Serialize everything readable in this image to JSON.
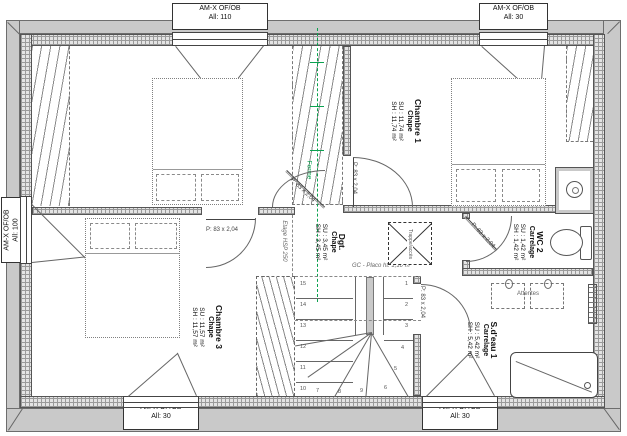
{
  "plan": {
    "windows": [
      {
        "id": "top-left",
        "line1": "AM-X OF/OB",
        "line2": "All: 110"
      },
      {
        "id": "top-right",
        "line1": "AM-X OF/OB",
        "line2": "All: 30"
      },
      {
        "id": "left",
        "line1": "AM-X OF/OB",
        "line2": "All: 100"
      },
      {
        "id": "bottom-left",
        "line1": "AM-X OF/OB",
        "line2": "All: 30"
      },
      {
        "id": "bottom-right",
        "line1": "AM-X OF/OB",
        "line2": "All: 30"
      }
    ],
    "rooms": [
      {
        "id": "chambre2",
        "name": "Chambre 2",
        "finish": "Chape",
        "su": "SU : 11,75 m²",
        "sh": "SH : 11,75 m²"
      },
      {
        "id": "chambre1",
        "name": "Chambre 1",
        "finish": "Chape",
        "su": "SU : 11,74 m²",
        "sh": "SH : 11,74 m²"
      },
      {
        "id": "chambre3",
        "name": "Chambre 3",
        "finish": "Chape",
        "su": "SU : 11,57 m²",
        "sh": "SH : 11,57 m²"
      },
      {
        "id": "dgt",
        "name": "Dgt.",
        "finish": "Chape",
        "su": "SU : 3,45 m²",
        "sh": "SH : 3,45 m²"
      },
      {
        "id": "wc2",
        "name": "WC 2",
        "finish": "Carrelage",
        "su": "SU : 1,42 m²",
        "sh": "SH : 1,42 m²"
      },
      {
        "id": "sdeau1",
        "name": "S.d'eau 1",
        "finish": "Carrelage",
        "su": "SU : 5,42 m²",
        "sh": "SH : 5,42 m²"
      }
    ],
    "door_label": "P: 83 x 2,04",
    "annotations": {
      "ferme": "Ferme",
      "etage": "Etage HSP 250",
      "gc_placo": "GC - Placo ht. 1,10 m",
      "trappe": "Trappe/accès",
      "attentes": "Attentes"
    },
    "stairs": {
      "left_numbers": [
        "15",
        "14",
        "13",
        "12",
        "11",
        "10"
      ],
      "right_numbers": [
        "1",
        "2",
        "3",
        "4",
        "5",
        "6"
      ],
      "fan_numbers": [
        "7",
        "8",
        "9"
      ]
    },
    "colors": {
      "truss_green": "#0aa14f",
      "wall_fill": "#e4e4e4",
      "band_fill": "#c9c9c9",
      "line": "#555555"
    }
  }
}
